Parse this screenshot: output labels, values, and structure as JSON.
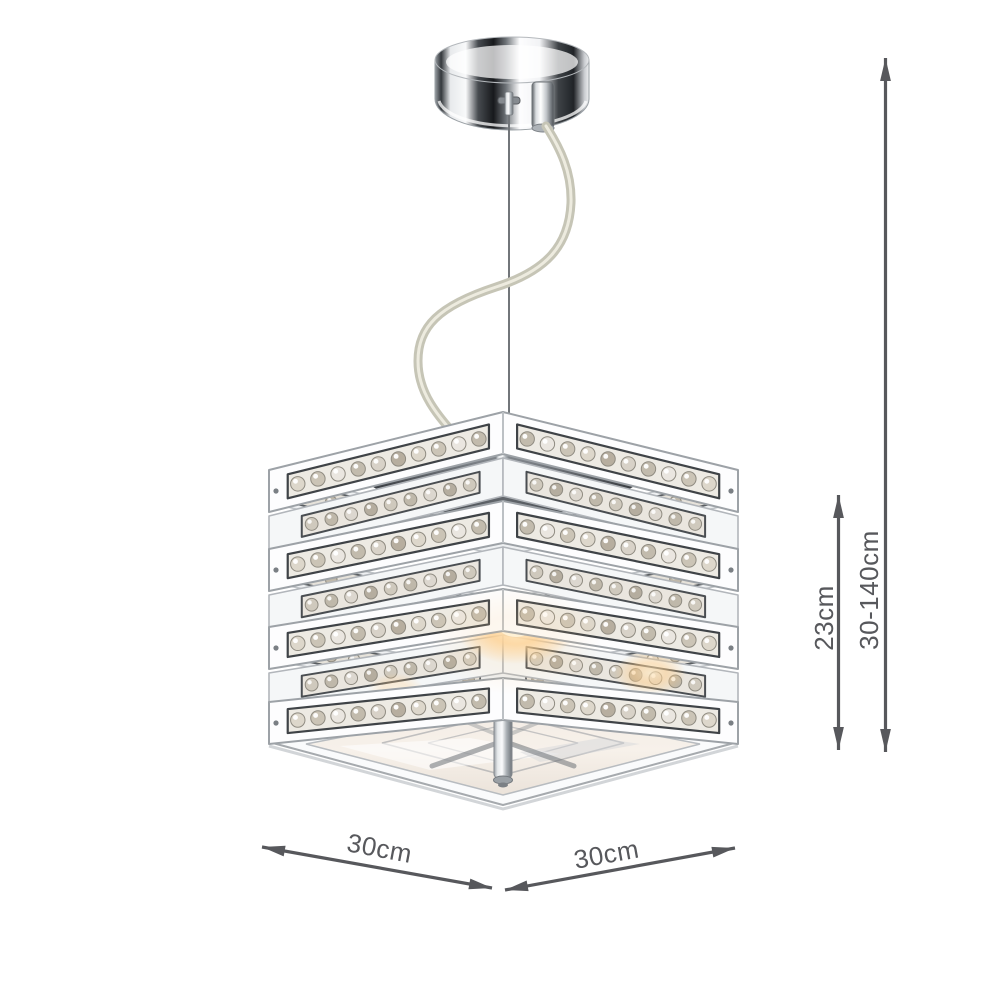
{
  "page": {
    "background": "#ffffff"
  },
  "dimension_labels": {
    "shade_height": "23cm",
    "drop_range": "30-140cm",
    "width": "30cm",
    "depth": "30cm"
  },
  "style": {
    "annotation_color": "#57585c",
    "chrome_dark": "#2e3134",
    "chrome_light": "#f2f4f5",
    "crystal_tint": "#d8d2c6",
    "bulb_glow": "#ffcf8e"
  }
}
